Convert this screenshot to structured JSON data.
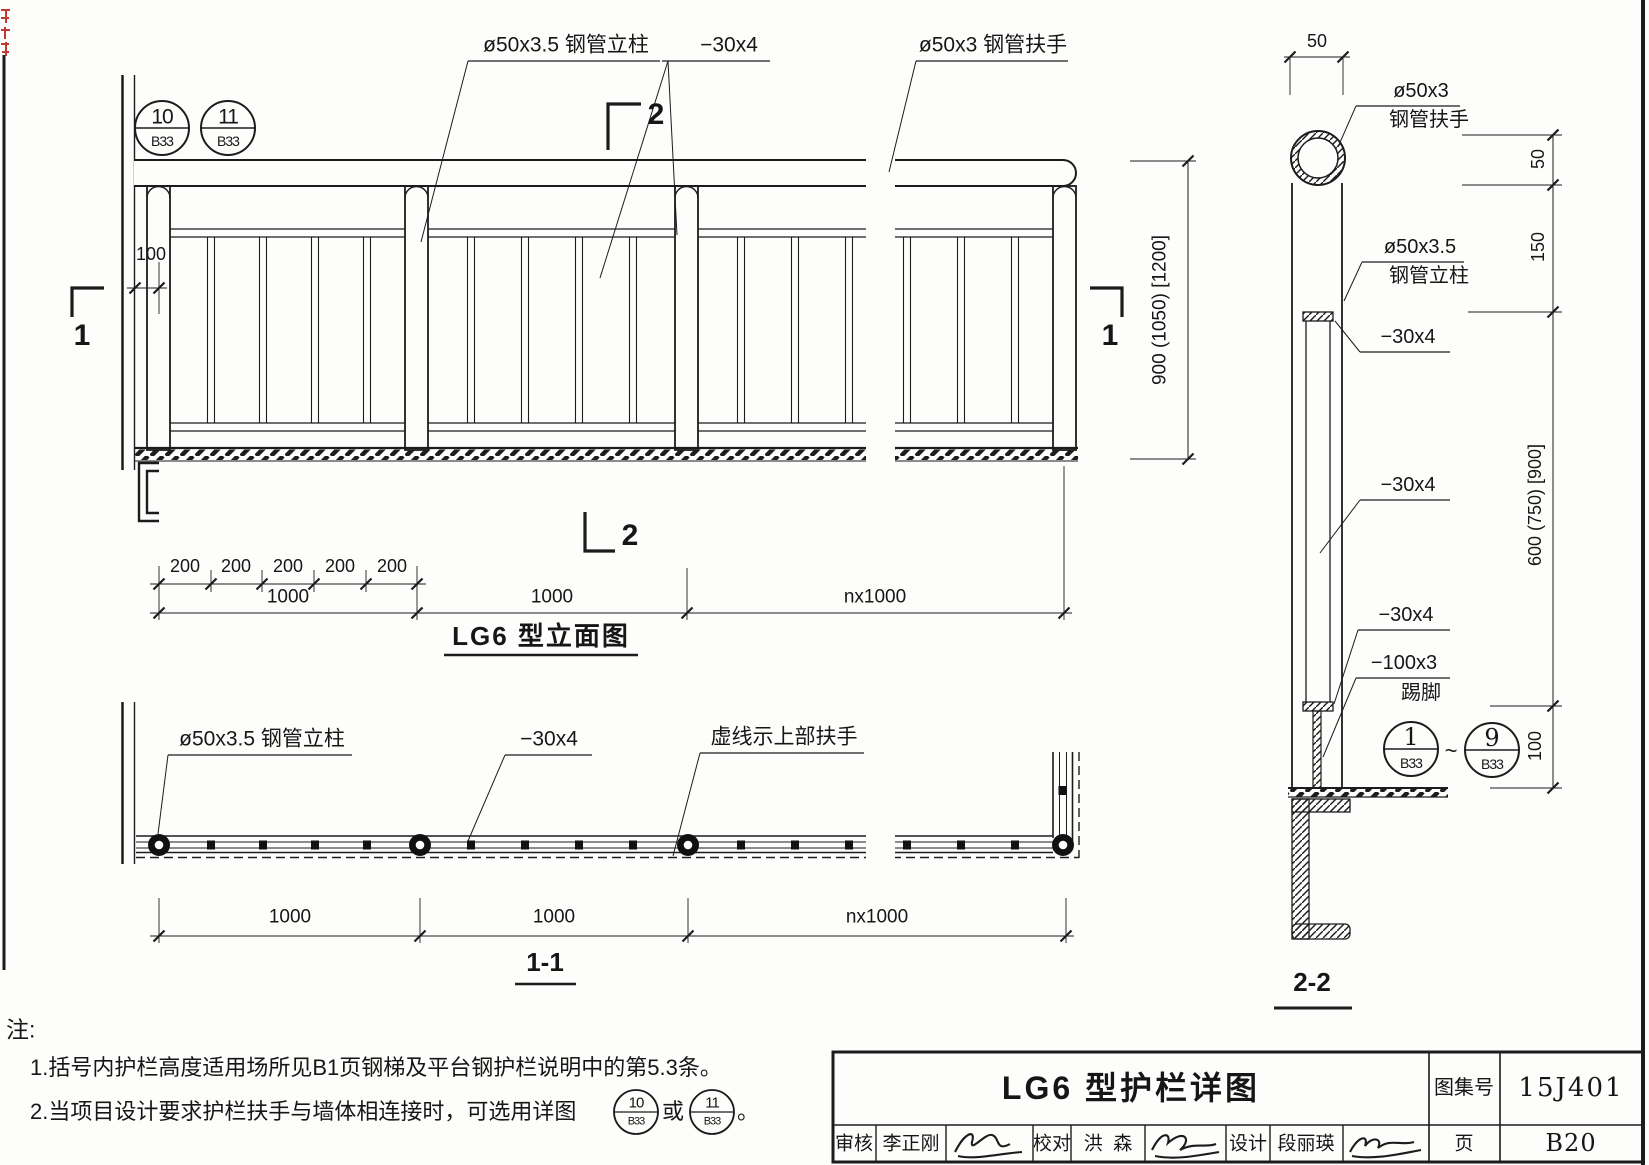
{
  "drawing": {
    "line_color": "#1c1c1c",
    "red_accent": "#c23a32"
  },
  "elevation": {
    "title": "LG6 型立面图",
    "bubble_10": {
      "num": "10",
      "ref": "B33"
    },
    "bubble_11": {
      "num": "11",
      "ref": "B33"
    },
    "label_post": "ø50x3.5 钢管立柱",
    "label_flatbar": "−30x4",
    "label_handrail": "ø50x3 钢管扶手",
    "dim_offset": "100",
    "dim_height": "900 (1050) [1200]",
    "dims_200": [
      "200",
      "200",
      "200",
      "200",
      "200"
    ],
    "dim_bay1": "1000",
    "dim_bay2": "1000",
    "dim_bayn": "nx1000",
    "marker_1": "1",
    "marker_2": "2"
  },
  "plan": {
    "title": "1-1",
    "label_post": "ø50x3.5 钢管立柱",
    "label_flatbar": "−30x4",
    "label_dashed": "虚线示上部扶手",
    "dim_bay1": "1000",
    "dim_bay2": "1000",
    "dim_bayn": "nx1000"
  },
  "section": {
    "title": "2-2",
    "dim_top": "50",
    "handrail_spec": "ø50x3",
    "handrail_name": "钢管扶手",
    "post_spec": "ø50x3.5",
    "post_name": "钢管立柱",
    "toprail": "−30x4",
    "midbar": "−30x4",
    "botrail": "−30x4",
    "toe_spec": "−100x3",
    "toe_name": "踢脚",
    "dim_50": "50",
    "dim_150": "150",
    "dim_main": "600 (750) [900]",
    "dim_100": "100",
    "bubble_start": {
      "num": "1",
      "ref": "B33"
    },
    "tilde": "~",
    "bubble_end": {
      "num": "9",
      "ref": "B33"
    }
  },
  "notes": {
    "head": "注:",
    "item1": "1.括号内护栏高度适用场所见B1页钢梯及平台钢护栏说明中的第5.3条。",
    "item2_pre": "2.当项目设计要求护栏扶手与墙体相连接时，可选用详图",
    "item2_or": "或",
    "item2_end": "。",
    "bubble_a": {
      "num": "10",
      "ref": "B33"
    },
    "bubble_b": {
      "num": "11",
      "ref": "B33"
    }
  },
  "titleblock": {
    "title": "LG6 型护栏详图",
    "atlas_label": "图集号",
    "atlas_no": "15J401",
    "page_label": "页",
    "page_no": "B20",
    "reviewer_label": "审核",
    "reviewer": "李正刚",
    "checker_label": "校对",
    "checker": "洪  森",
    "designer_label": "设计",
    "designer": "段丽瑛"
  }
}
